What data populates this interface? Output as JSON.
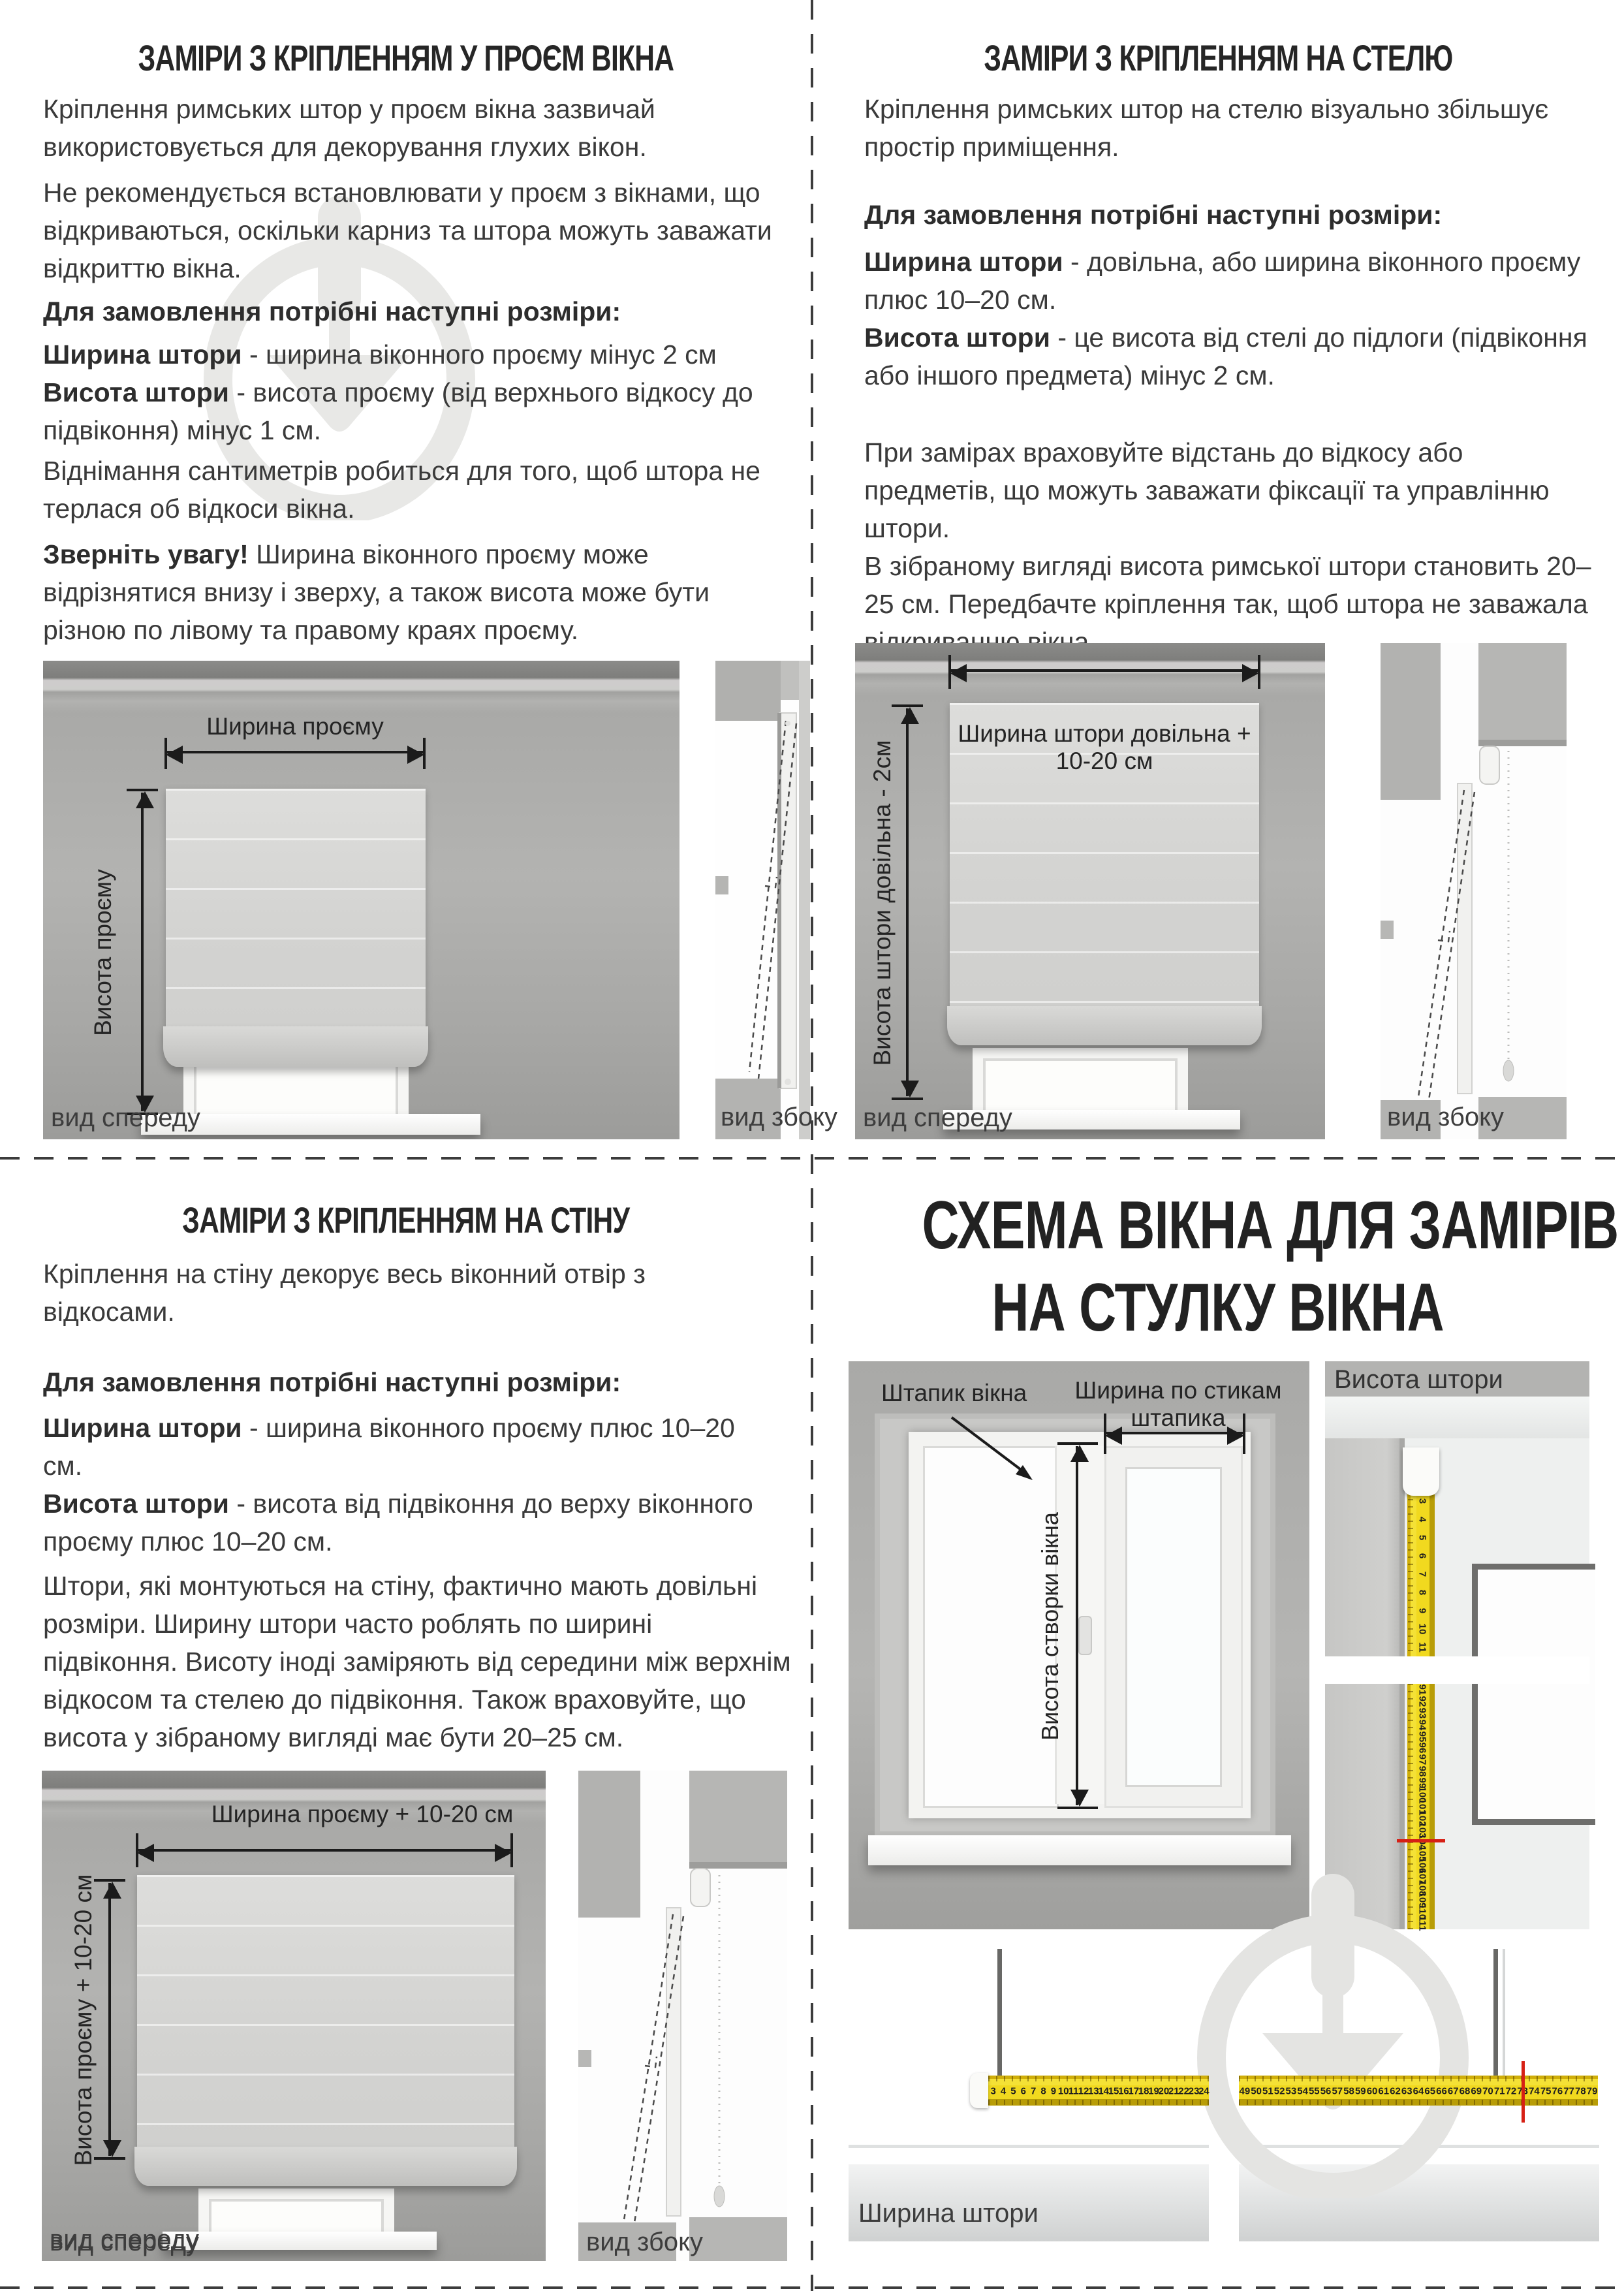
{
  "doc": {
    "tl": {
      "title": "ЗАМІРИ З КРІПЛЕННЯМ У ПРОЄМ ВІКНА",
      "p1": "Кріплення римських штор у проєм вікна зазвичай використовується для декорування глухих вікон.",
      "p2": "Не рекомендується встановлювати у проєм з вікнами, що відкриваються, оскільки карниз та штора можуть заважати відкриттю вікна.",
      "order_heading": "Для замовлення потрібні наступні розміри:",
      "width_term": "Ширина штори",
      "width_rest": " - ширина віконного проєму мінус 2 см",
      "height_term": "Висота штори",
      "height_rest": " - висота проєму (від верхнього відкосу до підвіконня) мінус 1 см.",
      "p5": "Віднімання сантиметрів робиться для того, щоб штора не терлася об відкоси вікна.",
      "note_term": "Зверніть увагу!",
      "note_rest": " Ширина віконного проєму може відрізнятися внизу і зверху, а також висота може бути різною по лівому та правому краях проєму.",
      "dim_width": "Ширина проєму",
      "dim_height": "Висота проєму",
      "front_view": "вид спереду",
      "side_view": "вид збоку"
    },
    "tr": {
      "title": "ЗАМІРИ З КРІПЛЕННЯМ НА СТЕЛЮ",
      "p1": "Кріплення римських штор на стелю візуально збільшує простір приміщення.",
      "order_heading": "Для замовлення потрібні наступні розміри:",
      "width_term": "Ширина штори",
      "width_rest": " - довільна, або ширина віконного проєму плюс 10–20 см.",
      "height_term": "Висота штори",
      "height_rest": " - це висота від стелі до підлоги (підвіконня або іншого предмета) мінус 2 см.",
      "p4": "При замірах враховуйте відстань до відкосу або предметів, що можуть заважати фіксації та управлінню штори.\nВ зібраному вигляді висота римської штори становить 20–25 см. Передбачте кріплення так, щоб штора не заважала відкриванню вікна.",
      "dim_width": "Ширина штори довільна + 10-20 см",
      "dim_height": "Висота штори довільна - 2см",
      "front_view": "вид спереду",
      "side_view": "вид збоку"
    },
    "bl": {
      "title": "ЗАМІРИ З КРІПЛЕННЯМ НА СТІНУ",
      "p1": "Кріплення на стіну декорує весь віконний отвір з відкосами.",
      "order_heading": "Для замовлення потрібні наступні розміри:",
      "width_term": "Ширина штори",
      "width_rest": " - ширина віконного проєму плюс 10–20 см.",
      "height_term": "Висота штори",
      "height_rest": " - висота від підвіконня до верху віконного проєму плюс 10–20 см.",
      "p4": "Штори, які монтуються на стіну, фактично мають довільні розміри. Ширину штори часто роблять по ширині підвіконня. Висоту іноді заміряють від середини між верхнім відкосом та стелею до підвіконня. Також враховуйте, що висота у зібраному вигляді має бути 20–25 см.",
      "dim_width": "Ширина проєму + 10-20 см",
      "dim_height": "Висота проєму + 10-20 см",
      "front_view": "вид спереду",
      "side_view": "вид збоку"
    },
    "br": {
      "title_line1": "СХЕМА ВІКНА ДЛЯ ЗАМІРІВ",
      "title_line2": "НА СТУЛКУ ВІКНА",
      "label_bead": "Штапик вікна",
      "label_bead_width_line1": "Ширина по стикам",
      "label_bead_width_line2": "штапика",
      "label_sash_height": "Висота створки вікна",
      "label_curtain_height": "Висота штори",
      "label_curtain_width": "Ширина штори",
      "tape_vertical_top_numbers": [
        "3",
        "4",
        "5",
        "6",
        "7",
        "8",
        "9",
        "10",
        "11"
      ],
      "tape_vertical_bottom_numbers": [
        "91",
        "92",
        "93",
        "94",
        "95",
        "96",
        "97",
        "98",
        "99",
        "100",
        "101",
        "102",
        "103",
        "104",
        "105",
        "106",
        "107",
        "108",
        "109",
        "110",
        "111"
      ],
      "tape_vertical_red_mark_value": "104",
      "tape_horizontal_left_numbers": [
        "3",
        "4",
        "5",
        "6",
        "7",
        "8",
        "9",
        "10",
        "11",
        "12",
        "13",
        "14",
        "15",
        "16",
        "17",
        "18",
        "19",
        "20",
        "21",
        "22",
        "23",
        "24"
      ],
      "tape_horizontal_right_numbers": [
        "49",
        "50",
        "51",
        "52",
        "53",
        "54",
        "55",
        "56",
        "57",
        "58",
        "59",
        "60",
        "61",
        "62",
        "63",
        "64",
        "65",
        "66",
        "67",
        "68",
        "69",
        "70",
        "71",
        "72",
        "73",
        "74",
        "75",
        "76",
        "77",
        "78",
        "79"
      ],
      "tape_horizontal_red_mark_value": "73"
    }
  }
}
